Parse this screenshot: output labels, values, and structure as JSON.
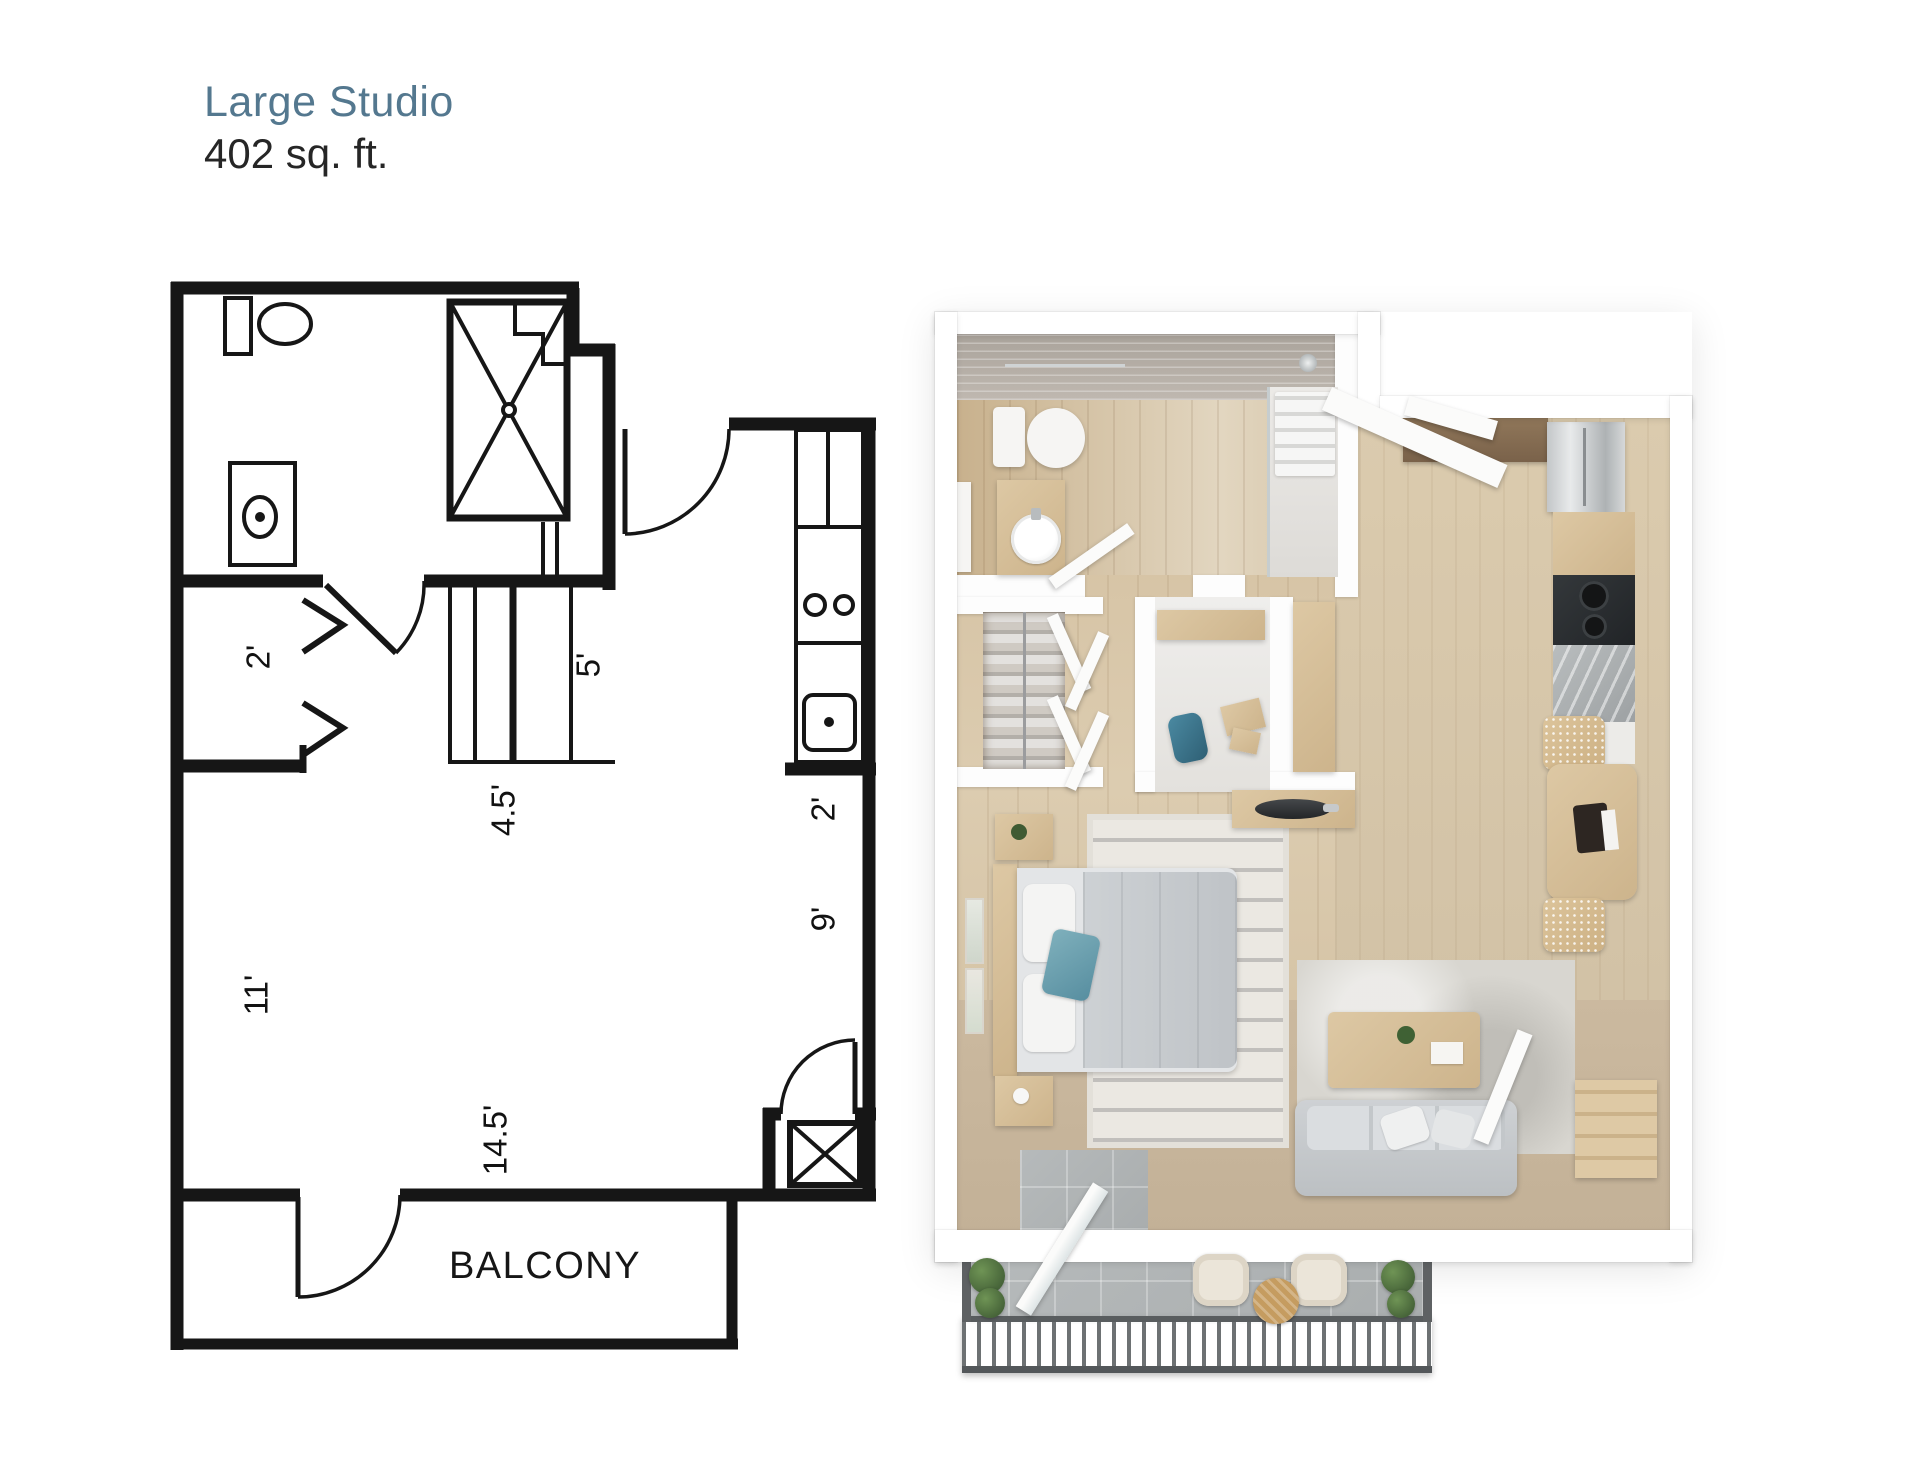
{
  "header": {
    "title": "Large Studio",
    "area": "402 sq. ft.",
    "title_color": "#54788f",
    "area_color": "#262626"
  },
  "floorplan_2d": {
    "line_color": "#161616",
    "room_labels": [
      {
        "id": "balcony",
        "label": "BALCONY"
      }
    ],
    "dimensions": [
      {
        "id": "closet-depth",
        "label": "2'"
      },
      {
        "id": "bedroom-wall",
        "label": "11'"
      },
      {
        "id": "closet-width",
        "label": "4.5'"
      },
      {
        "id": "hall-width",
        "label": "5'"
      },
      {
        "id": "kitchen-depth",
        "label": "2'"
      },
      {
        "id": "kitchen-run",
        "label": "9'"
      },
      {
        "id": "living-width",
        "label": "14.5'"
      }
    ],
    "fixtures": [
      "toilet",
      "sink-vanity",
      "shower",
      "bifold-closet-doors",
      "kitchen-counter",
      "stove-burners",
      "kitchen-sink",
      "utility-closet",
      "entry-door",
      "bathroom-door",
      "balcony-door"
    ]
  },
  "floorplan_3d": {
    "palette": {
      "wall": "#ffffff",
      "wood_floor": "#d3bf9f",
      "carpet": "#c7b59c",
      "balcony_tile": "#b0b4b5",
      "furniture_wood": "#d8c29c",
      "sofa_gray": "#c9cccf",
      "accent_teal": "#6ea7b5",
      "plant_green": "#527246"
    },
    "rooms": [
      "bathroom",
      "kitchen",
      "closet",
      "desk-nook",
      "bedroom",
      "living-area",
      "dining-nook",
      "balcony"
    ],
    "furniture": [
      "toilet",
      "vanity-sink",
      "shower",
      "fridge",
      "cooktop",
      "wardrobe-clothes",
      "bed",
      "nightstands",
      "rug",
      "sofa",
      "coffee-table",
      "dining-table",
      "mesh-chairs",
      "balcony-chairs",
      "balcony-table",
      "railing",
      "plants"
    ]
  }
}
